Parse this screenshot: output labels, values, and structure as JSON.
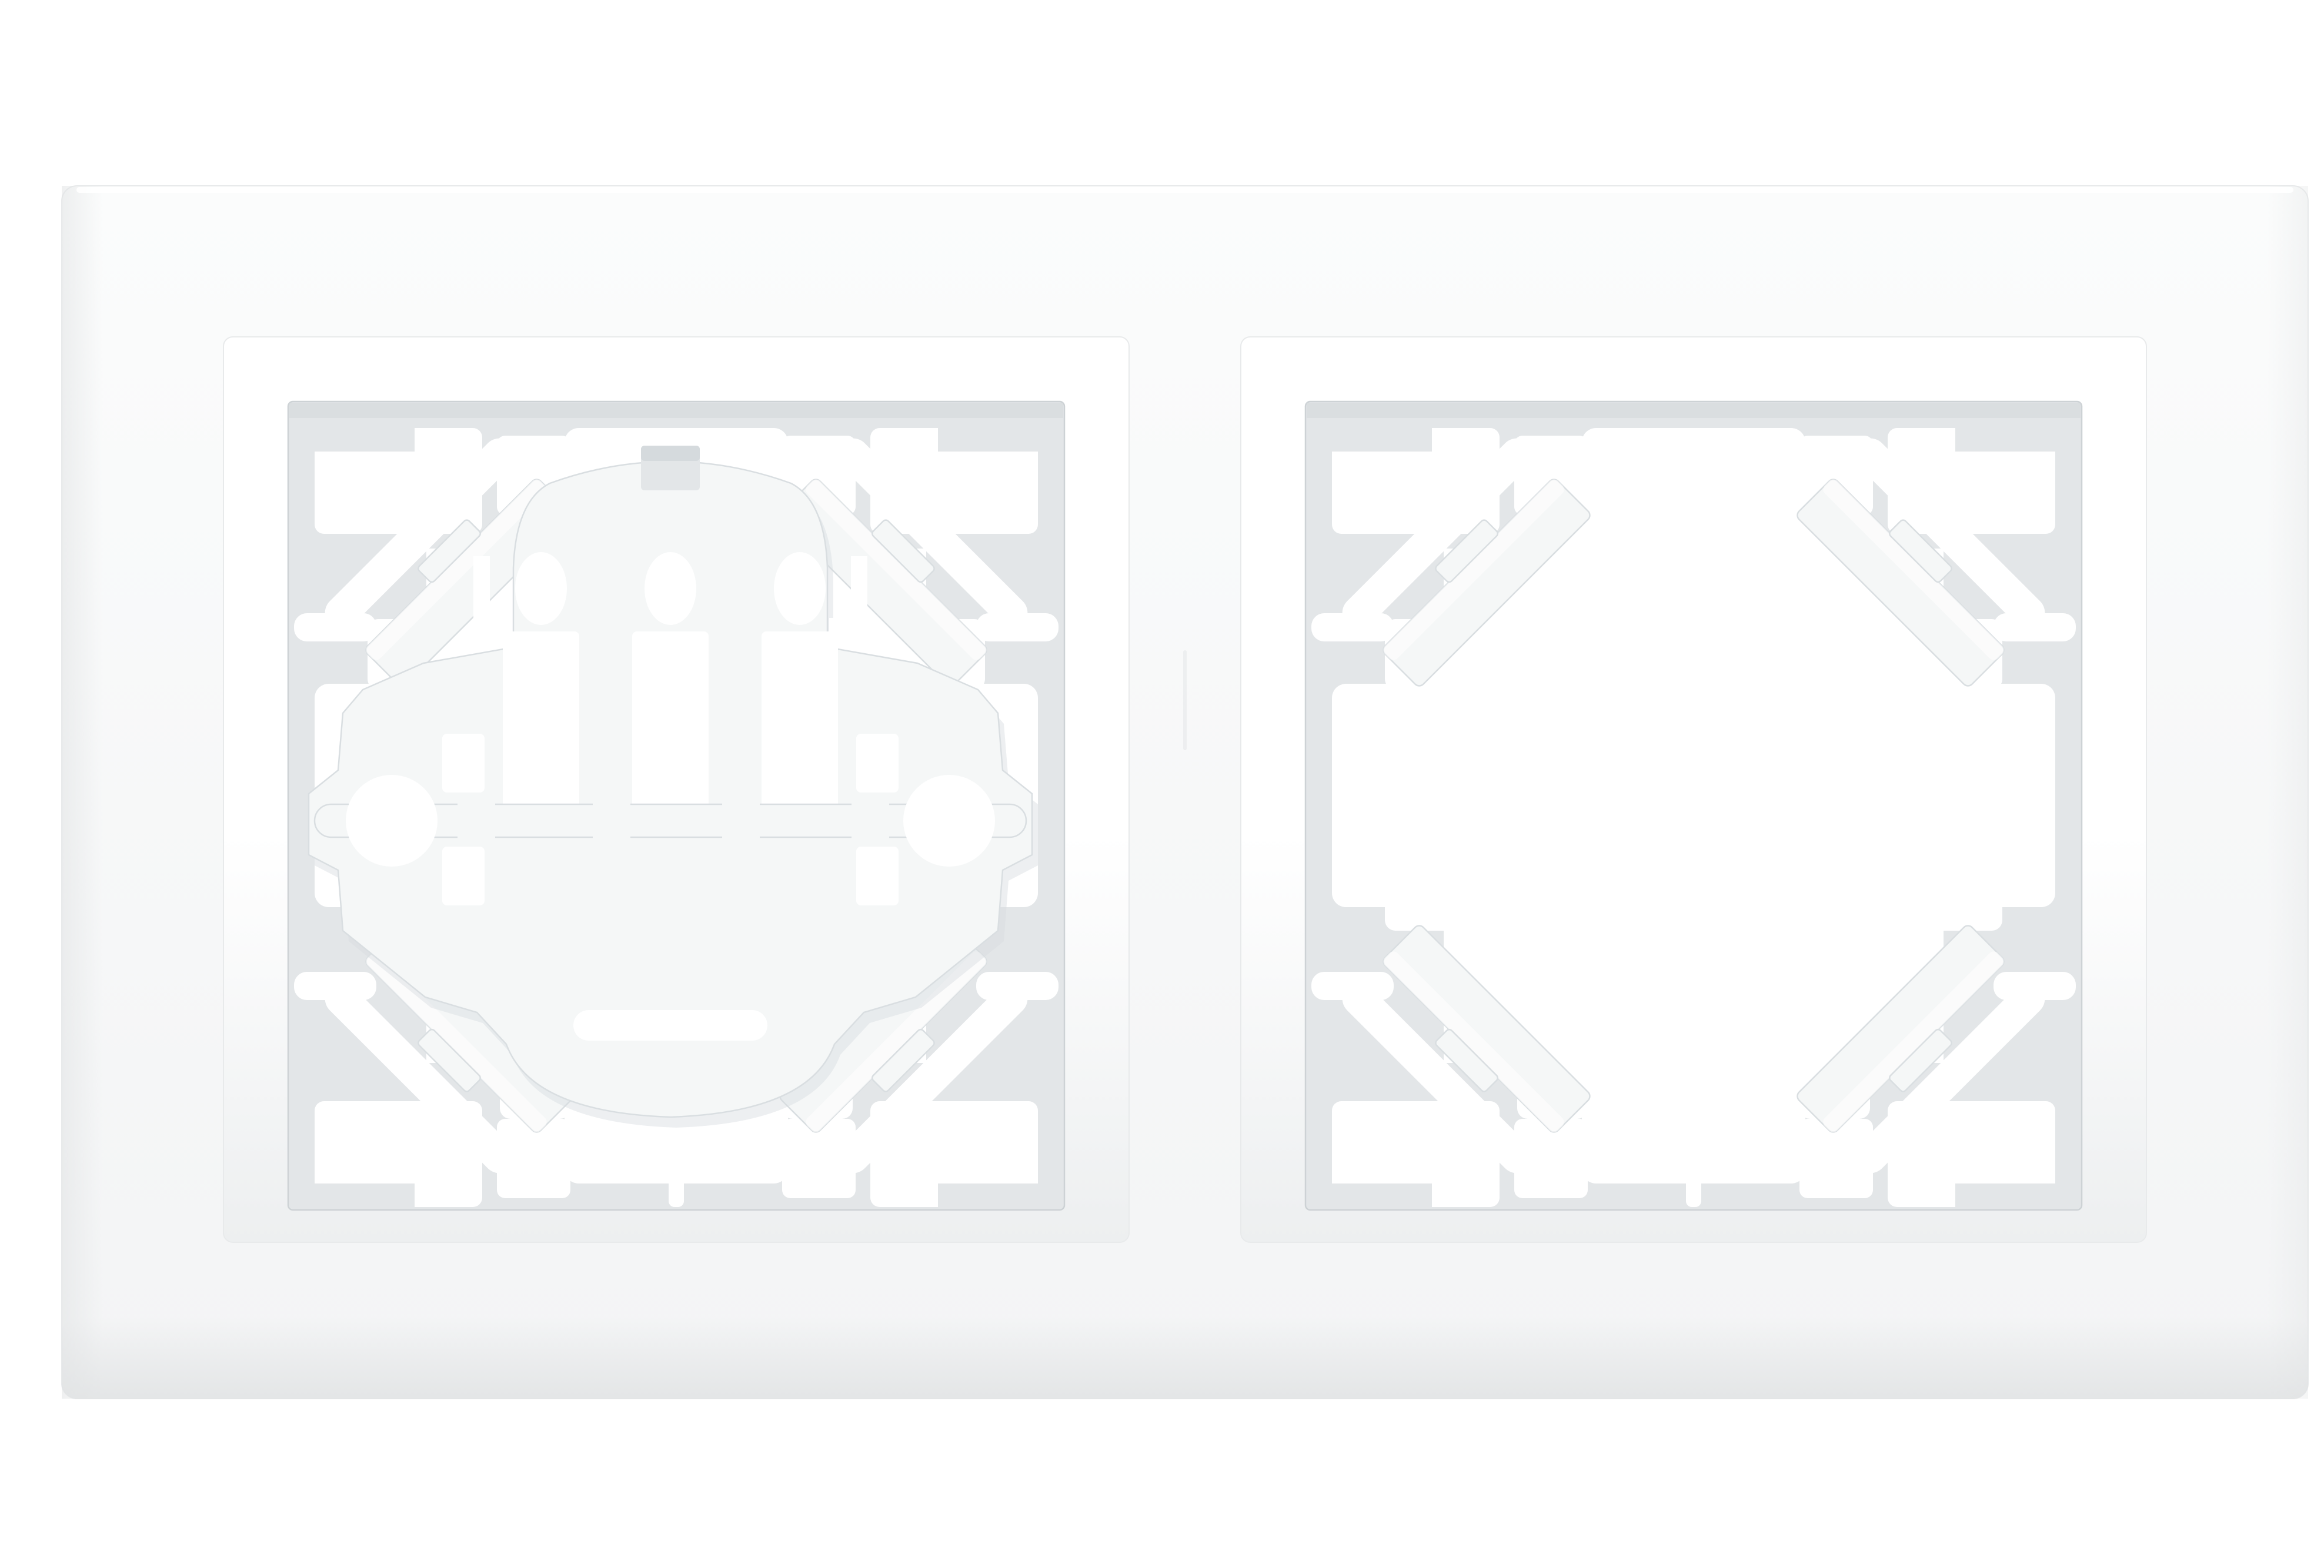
{
  "image": {
    "alt": "Studio product photo on a white background: a white plastic two-gang wall switch frame lying horizontally. The left square aperture holds a mounted switch support mechanism with an arched top, three oval holes, three vertical slots, a horizontal axle bar, two round fixing-screw holes and side trunnions. The right square aperture is empty, showing the grey rear cavity ring with four diagonal corner spring clips and rows of small rectangular mounting holes around a large central cut-out."
  },
  "colors": {
    "bg": "#ffffff",
    "plate_top": "#fbfcfc",
    "plate_bottom": "#f3f4f5",
    "plate_edge": "#e1e3e4",
    "plate_line": "#e8eaeb",
    "bevel_top": "#ffffff",
    "bevel_bottom": "#edeff0",
    "cavity": "#e3e6e8",
    "cavity_line": "#cdd2d5",
    "cavity_shadow": "#d5dadd",
    "hole": "#ffffff",
    "mech": "#f5f7f7",
    "mech_line": "#d9dee1",
    "mech_shadow": "#d7dcdf"
  },
  "parts": {
    "plate": "two-gang frame plate",
    "left_aperture": "aperture with switch support mechanism",
    "right_aperture": "empty aperture",
    "corner_clip": "diagonal corner spring clip",
    "mechanism": "switch support plate",
    "oval_holes": "three oval openings",
    "vertical_slots": "three vertical slots",
    "axle": "central axle bar",
    "screw_holes": "left and right fixing-screw holes",
    "trunnions": "side trunnion stubs"
  }
}
